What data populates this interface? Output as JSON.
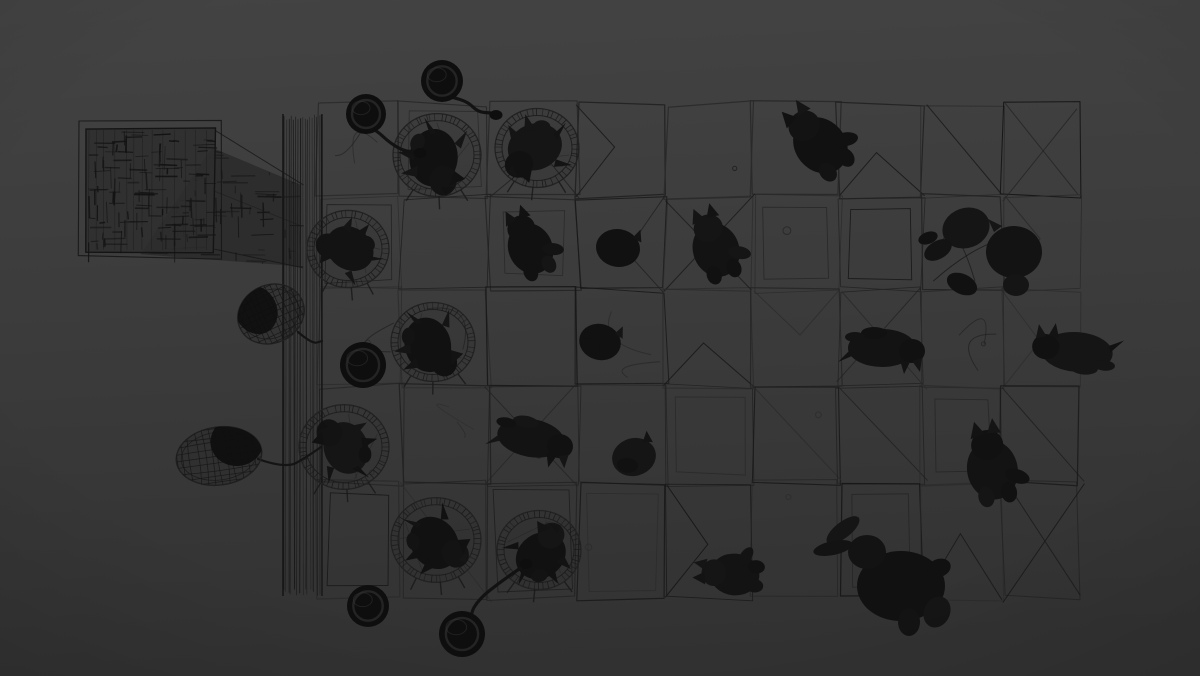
{
  "canvas": {
    "w": 1200,
    "h": 676,
    "bg_top": "#434343",
    "bg_mid": "#3b3b3b",
    "bg_bot": "#323232",
    "line": "#222222",
    "line_dark": "#171717",
    "line_light": "#2b2b2b",
    "ink": "#121212",
    "counter_fill": "#2b2b2b",
    "hatch": "#151515",
    "seed": 13
  },
  "objects": [
    {
      "t": "grid",
      "cols": [
        318,
        401,
        488,
        578,
        666,
        753,
        839,
        923,
        1003,
        1080
      ],
      "rows": [
        104,
        197,
        290,
        386,
        483,
        598
      ]
    },
    {
      "t": "counter",
      "box": [
        85,
        128,
        130,
        124
      ],
      "outer": [
        79,
        122,
        142,
        136
      ],
      "shadow": [
        [
          214,
          149
        ],
        [
          303,
          186
        ],
        [
          303,
          267
        ],
        [
          142,
          253
        ]
      ]
    },
    {
      "t": "column",
      "x": 283,
      "y": 114,
      "w": 39,
      "h": 482
    },
    {
      "t": "table",
      "cx": 437,
      "cy": 155,
      "r": 44
    },
    {
      "t": "table",
      "cx": 537,
      "cy": 148,
      "r": 42
    },
    {
      "t": "table",
      "cx": 348,
      "cy": 249,
      "r": 41
    },
    {
      "t": "table",
      "cx": 433,
      "cy": 342,
      "r": 42
    },
    {
      "t": "table",
      "cx": 344,
      "cy": 447,
      "r": 45
    },
    {
      "t": "table",
      "cx": 436,
      "cy": 540,
      "r": 45
    },
    {
      "t": "table",
      "cx": 539,
      "cy": 550,
      "r": 42
    },
    {
      "t": "cat",
      "cx": 437,
      "cy": 158,
      "rot": 95,
      "s": 1.15,
      "v": "table"
    },
    {
      "t": "cat",
      "cx": 536,
      "cy": 150,
      "rot": 160,
      "s": 1.1,
      "v": "table"
    },
    {
      "t": "cat",
      "cx": 348,
      "cy": 251,
      "rot": 215,
      "s": 1.0,
      "v": "table"
    },
    {
      "t": "cat",
      "cx": 431,
      "cy": 344,
      "rot": 75,
      "s": 1.1,
      "v": "table"
    },
    {
      "t": "cat",
      "cx": 343,
      "cy": 449,
      "rot": 250,
      "s": 1.05,
      "v": "table"
    },
    {
      "t": "cat",
      "cx": 437,
      "cy": 541,
      "rot": 55,
      "s": 1.1,
      "v": "table"
    },
    {
      "t": "cat",
      "cx": 539,
      "cy": 553,
      "rot": 325,
      "s": 1.05,
      "v": "table"
    },
    {
      "t": "cat",
      "cx": 528,
      "cy": 243,
      "rot": -25,
      "s": 1.0,
      "v": "sit"
    },
    {
      "t": "cat",
      "cx": 618,
      "cy": 248,
      "rot": 10,
      "s": 1.05,
      "v": "curl"
    },
    {
      "t": "cat",
      "cx": 714,
      "cy": 244,
      "rot": -20,
      "s": 1.05,
      "v": "sit"
    },
    {
      "t": "cat",
      "cx": 816,
      "cy": 140,
      "rot": -40,
      "s": 1.15,
      "v": "sit"
    },
    {
      "t": "cat",
      "cx": 600,
      "cy": 342,
      "rot": 15,
      "s": 1.0,
      "v": "curl"
    },
    {
      "t": "cat",
      "cx": 882,
      "cy": 348,
      "rot": 180,
      "s": 1.0,
      "v": "lie"
    },
    {
      "t": "cat",
      "cx": 986,
      "cy": 252,
      "rot": 0,
      "s": 1.0,
      "v": "big"
    },
    {
      "t": "cat",
      "cx": 1077,
      "cy": 352,
      "rot": 4,
      "s": 1.05,
      "v": "lie"
    },
    {
      "t": "cat",
      "cx": 531,
      "cy": 438,
      "rot": 190,
      "s": 1.0,
      "v": "lie"
    },
    {
      "t": "cat",
      "cx": 634,
      "cy": 457,
      "rot": -15,
      "s": 1.05,
      "v": "curl"
    },
    {
      "t": "cat",
      "cx": 991,
      "cy": 463,
      "rot": -12,
      "s": 1.15,
      "v": "sit"
    },
    {
      "t": "cat",
      "cx": 895,
      "cy": 576,
      "rot": 0,
      "s": 1.0,
      "v": "bunny"
    },
    {
      "t": "cat",
      "cx": 729,
      "cy": 574,
      "rot": -85,
      "s": 0.95,
      "v": "sit"
    },
    {
      "t": "basket",
      "cx": 271,
      "cy": 314,
      "rx": 34,
      "ry": 29,
      "rot": -25,
      "dark": [
        -12,
        -10
      ],
      "cord": [
        [
          298,
          332
        ],
        [
          312,
          344
        ],
        [
          322,
          341
        ]
      ]
    },
    {
      "t": "basket",
      "cx": 219,
      "cy": 456,
      "rx": 43,
      "ry": 29,
      "rot": -8,
      "dark": [
        20,
        -12
      ],
      "cord": [
        [
          258,
          459
        ],
        [
          286,
          469
        ],
        [
          308,
          456
        ],
        [
          321,
          447
        ]
      ]
    },
    {
      "t": "pot",
      "cx": 363,
      "cy": 365,
      "r": 23
    },
    {
      "t": "pot",
      "cx": 368,
      "cy": 606,
      "r": 21
    },
    {
      "t": "balloon",
      "cx": 442,
      "cy": 81,
      "r": 21,
      "string": [
        [
          452,
          97
        ],
        [
          468,
          102
        ],
        [
          478,
          112
        ],
        [
          491,
          113
        ]
      ],
      "knot": [
        496,
        115
      ]
    },
    {
      "t": "balloon",
      "cx": 366,
      "cy": 114,
      "r": 20,
      "string": [
        [
          376,
          130
        ],
        [
          390,
          143
        ],
        [
          404,
          151
        ],
        [
          416,
          152
        ]
      ],
      "knot": [
        420,
        153
      ]
    },
    {
      "t": "balloon",
      "cx": 462,
      "cy": 634,
      "r": 23,
      "string": [
        [
          469,
          616
        ],
        [
          479,
          599
        ],
        [
          499,
          583
        ],
        [
          522,
          567
        ]
      ],
      "knot": [
        526,
        564
      ]
    }
  ]
}
